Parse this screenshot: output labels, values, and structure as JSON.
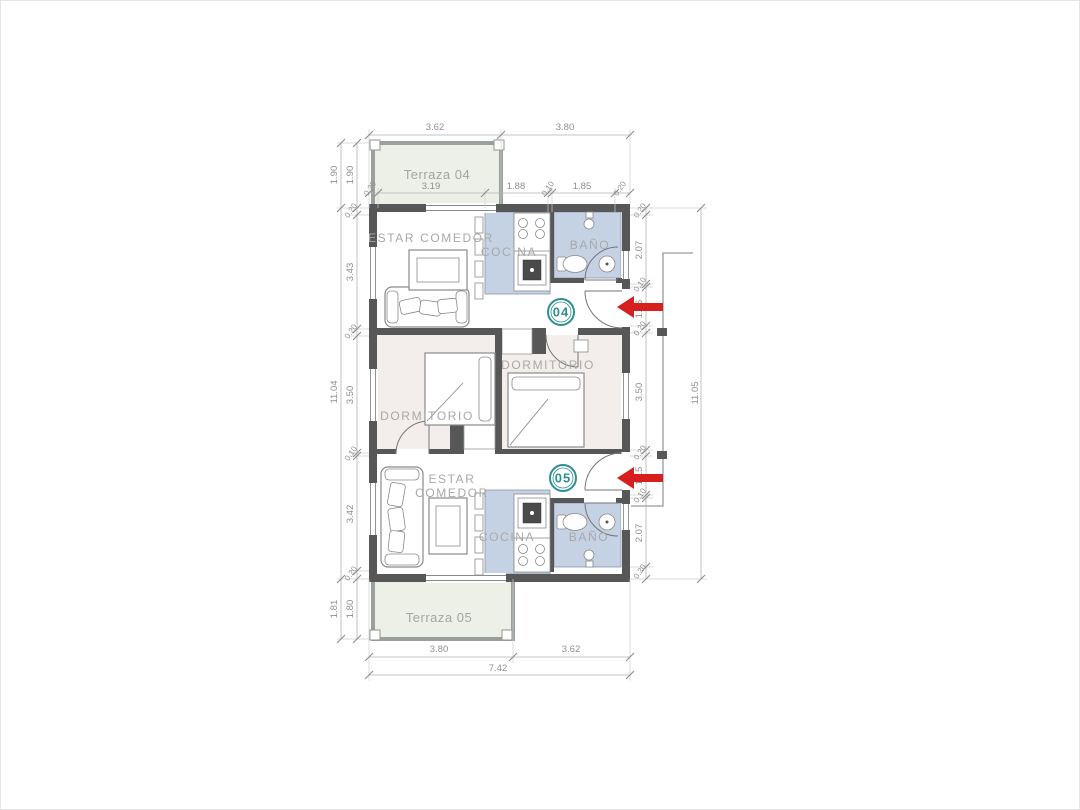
{
  "plan": {
    "title": "Floor plan units 04 and 05",
    "units": [
      {
        "id": "04",
        "badge": "04"
      },
      {
        "id": "05",
        "badge": "05"
      }
    ],
    "rooms": {
      "terraza_04": "Terraza 04",
      "terraza_05": "Terraza 05",
      "estar_comedor_04": "ESTAR COMEDOR",
      "estar_05_line1": "ESTAR",
      "estar_05_line2": "COMEDOR",
      "cocina_04": "COCINA",
      "cocina_05": "COCINA",
      "bano_04": "BAÑO",
      "bano_05": "BAÑO",
      "dormitorio_04": "DORMITORIO",
      "dormitorio_05": "DORMITORIO"
    },
    "dimensions": {
      "top_outer": [
        "3.62",
        "3.80"
      ],
      "top_inner": [
        "0.20",
        "3.19",
        "1.88",
        "0.10",
        "1.85",
        "0.20"
      ],
      "bottom_inner": [
        "3.80",
        "3.62"
      ],
      "bottom_total": "7.42",
      "left_outer": [
        "1.90",
        "11.04",
        "1.81"
      ],
      "left_inner": [
        "1.90",
        "0.20",
        "3.43",
        "0.20",
        "3.50",
        "0.10",
        "3.42",
        "0.20",
        "1.80"
      ],
      "right_inner": [
        "0.20",
        "2.07",
        "0.10",
        "1.16",
        "0.20",
        "3.50",
        "0.20",
        "1.15",
        "0.10",
        "2.07",
        "0.20"
      ],
      "right_outer": "11.05"
    },
    "colors": {
      "wall": "#575757",
      "terrace_fill": "#edf0e7",
      "kitchen_bath_fill": "#c5d2e4",
      "bedroom_fill": "#f3eeeb",
      "dimension_text": "#8f8f8f",
      "room_label": "#a8a8a8",
      "accent_teal": "#2e8f8f",
      "arrow_red": "#d71f1f"
    }
  }
}
